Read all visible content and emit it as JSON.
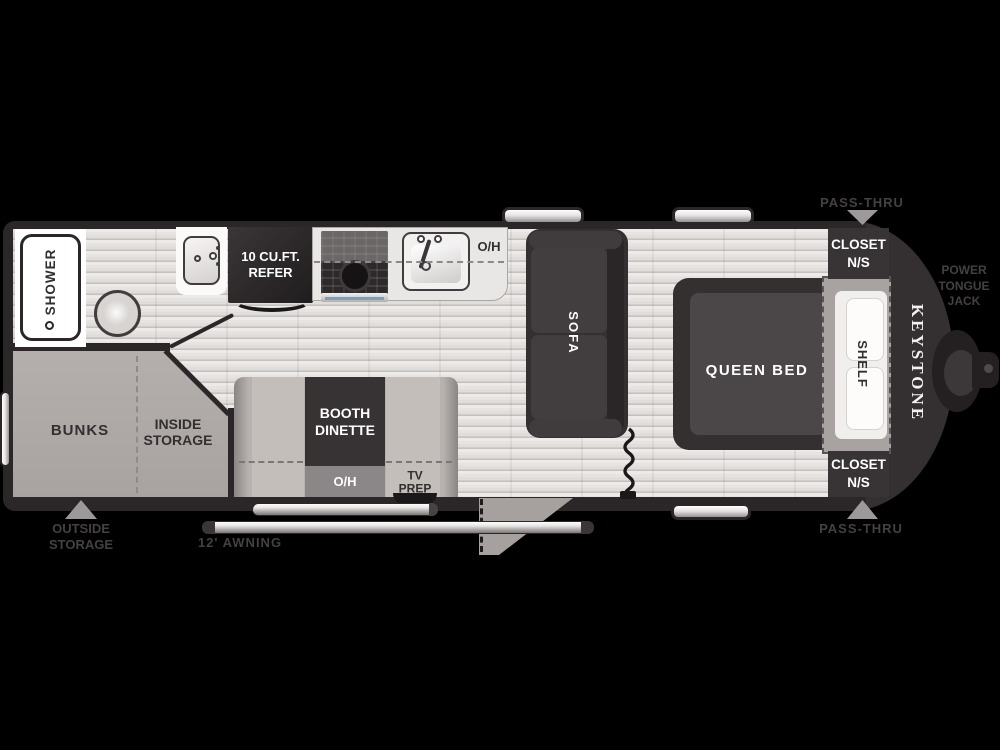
{
  "title": "Keystone travel trailer floor plan",
  "brand": {
    "logo": "KEYSTONE"
  },
  "labels": {
    "shower": "SHOWER",
    "refer": "10 CU.FT.\nREFER",
    "kitchen_oh": "O/H",
    "bunks": "BUNKS",
    "inside_storage": "INSIDE\nSTORAGE",
    "booth_dinette": "BOOTH\nDINETTE",
    "dinette_oh": "O/H",
    "tv_prep": "TV\nPREP",
    "sofa": "SOFA",
    "queen_bed": "QUEEN BED",
    "shelf": "SHELF",
    "closet_top": "CLOSET\nN/S",
    "closet_bottom": "CLOSET\nN/S",
    "pass_thru_top": "PASS-THRU",
    "pass_thru_bottom": "PASS-THRU",
    "outside_storage": "OUTSIDE\nSTORAGE",
    "awning": "12' AWNING",
    "power_tongue_jack": "POWER\nTONGUE\nJACK"
  },
  "colors": {
    "wall": "#2b2728",
    "wall2": "#343031",
    "dark": "#383435",
    "darker": "#2a2627",
    "mattress": "#4b4748",
    "gray": "#b2adaa",
    "gray2": "#a8a3a0",
    "seat": "#c3beba",
    "band": "#8b8687",
    "counter": "#e9e7e5",
    "ink": "#332f30",
    "ghost": "#454041",
    "tri": "#9d9899",
    "blue": "#7f9eb6",
    "white": "#ffffff"
  }
}
